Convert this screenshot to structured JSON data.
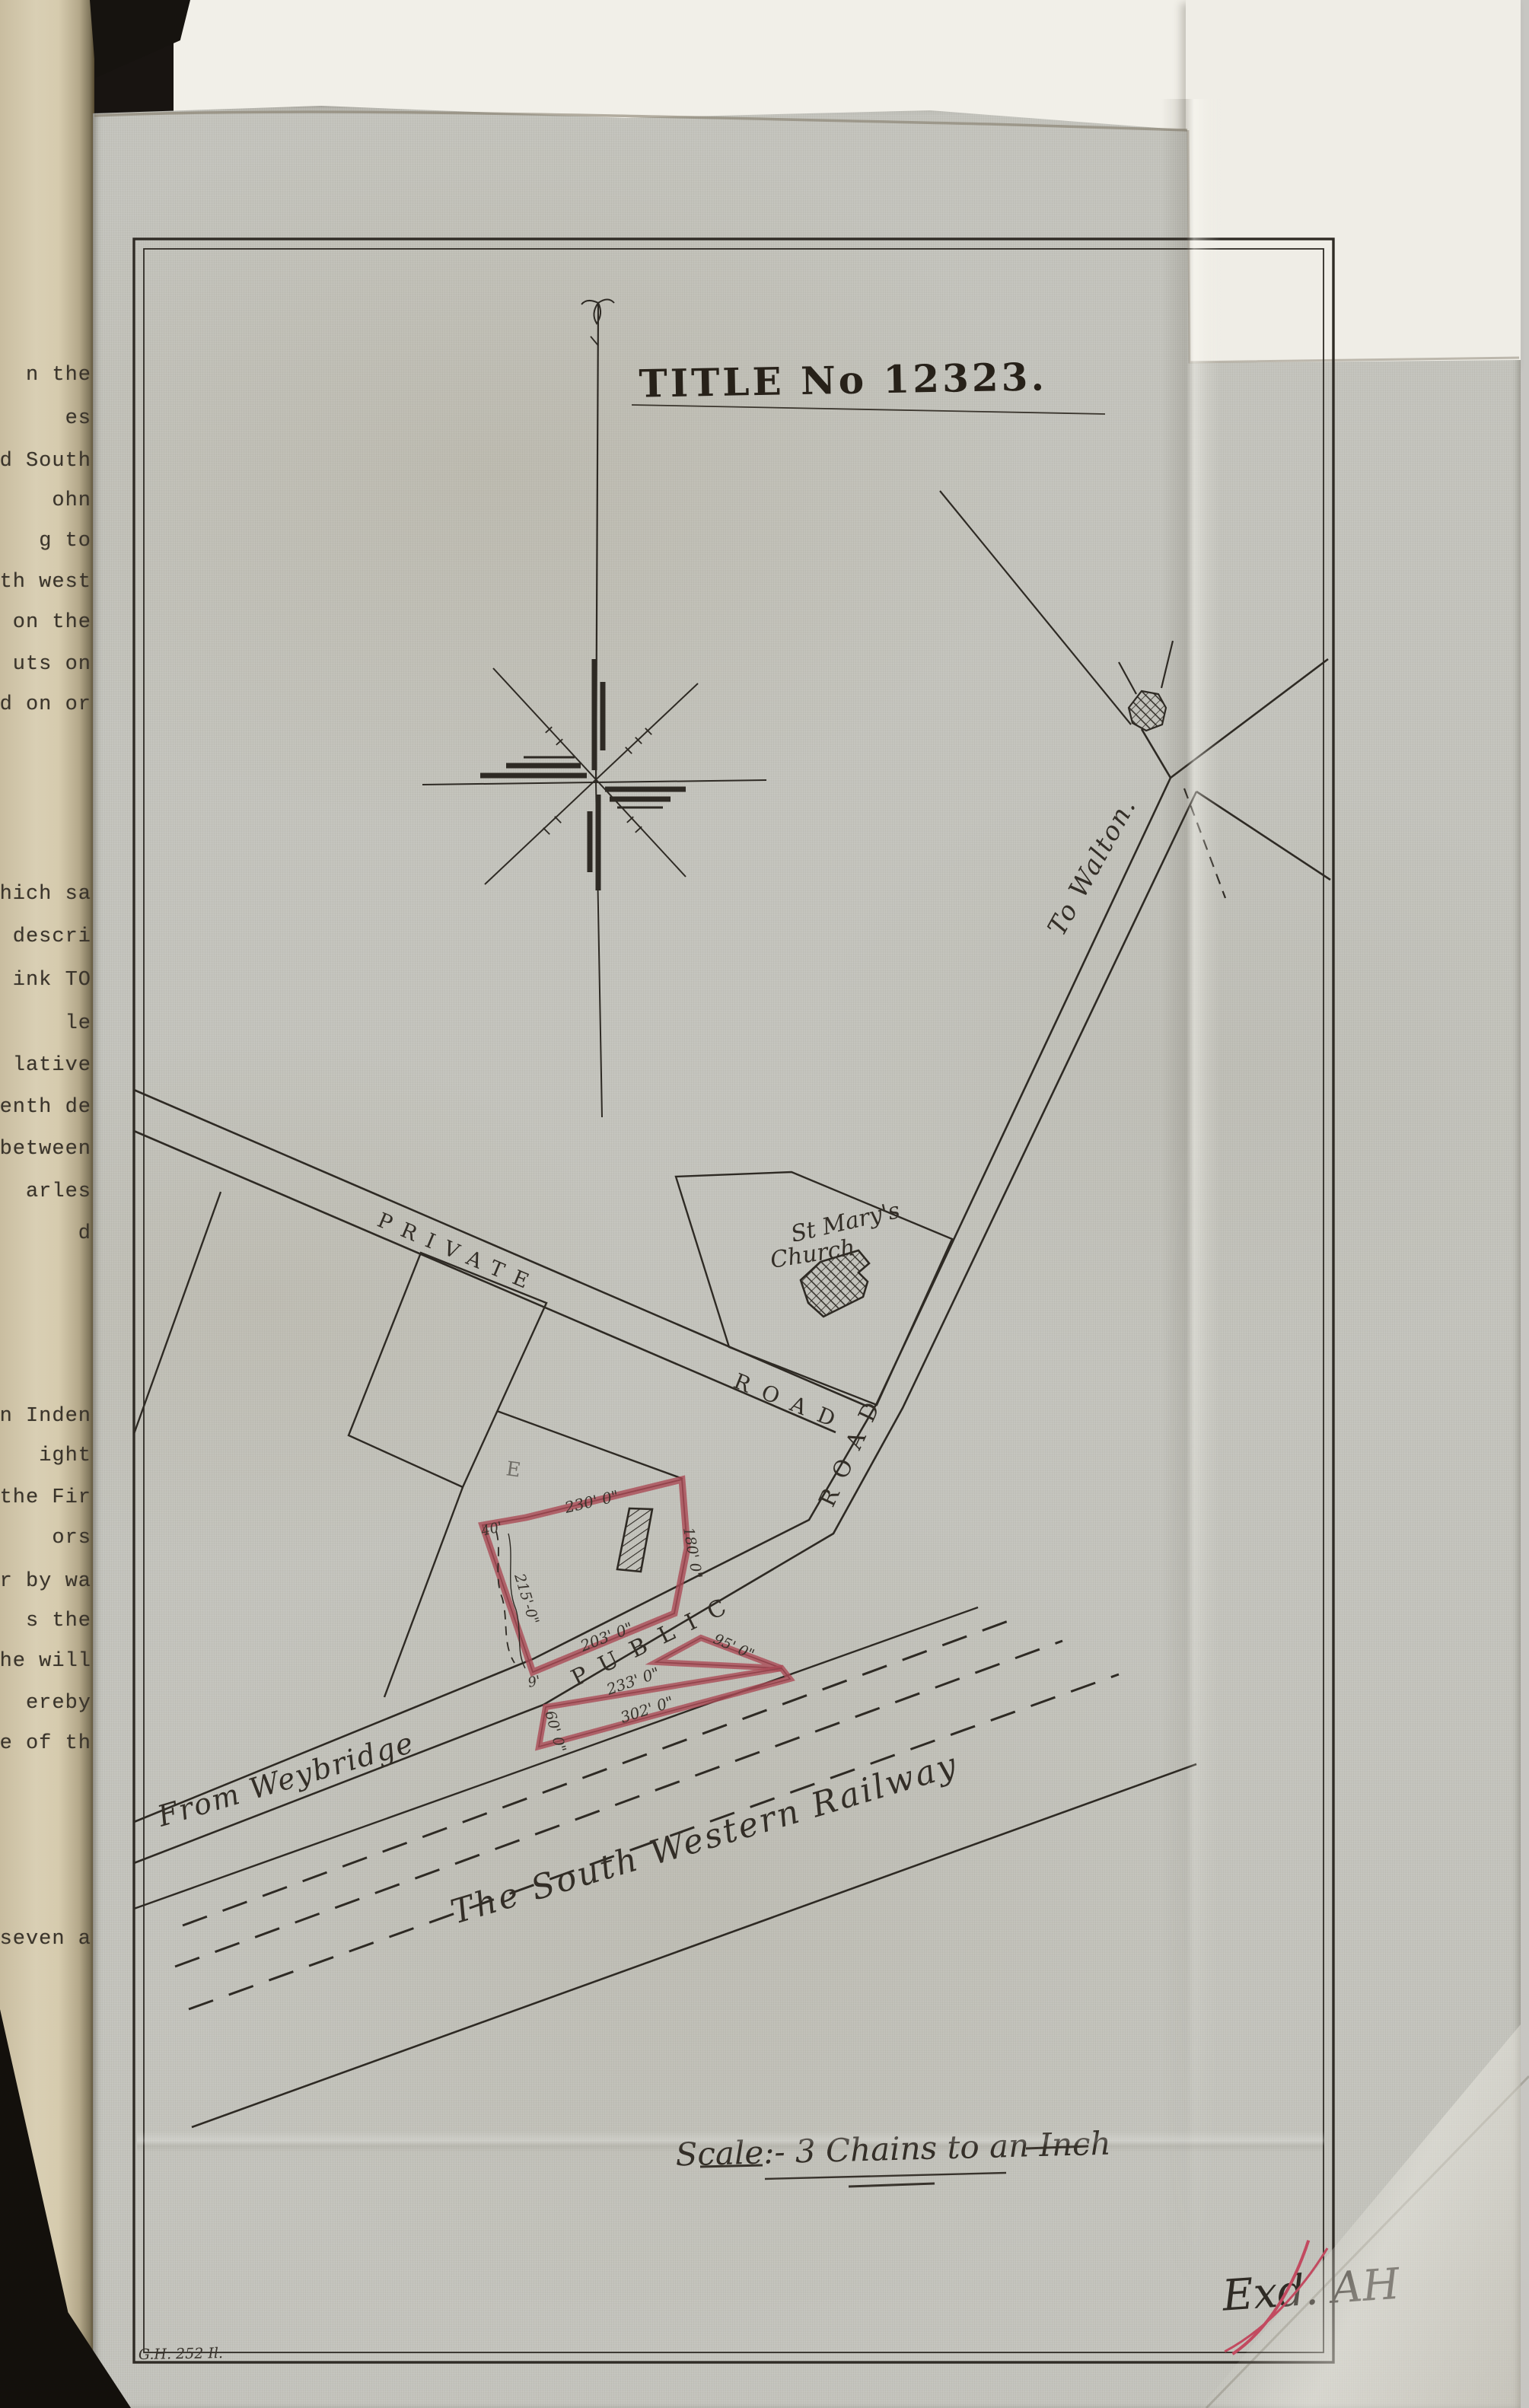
{
  "document": {
    "title": "TITLE No 12323.",
    "scale_note": "Scale:- 3 Chains to an Inch",
    "examiner_initials": "Exd. AH",
    "plate_ref": "G.H. 252 Il."
  },
  "map": {
    "labels": {
      "church_line1": "St Mary's",
      "church_line2": "Church",
      "to_walton": "To Walton.",
      "private_road": "PRIVATE",
      "private_road_2": "ROAD",
      "public_road": "PUBLIC",
      "public_road_2": "ROAD",
      "from_weybridge": "From Weybridge",
      "railway": "The South Western Railway",
      "pencil_mark": "E"
    },
    "measurements": {
      "main_top": "230' 0\"",
      "main_corner": "40'",
      "main_left": "215'-0\"",
      "main_right": "180' 0\"",
      "main_bottom": "203' 0\"",
      "corner_nine": "9'",
      "strip_top": "233' 0\"",
      "strip_bottom": "302' 0\"",
      "triangle_edge": "95' 0\"",
      "strip_left": "60' 0\""
    },
    "colors": {
      "parcel_outline": "#aa4a55",
      "signature_ink": "#c24a60",
      "drawing_ink": "#2f2b25",
      "fabric": "#c3c3bc"
    }
  },
  "left_page": {
    "fragments": [
      "n the",
      "es",
      "d South",
      "ohn",
      "g to",
      "th west",
      "on the",
      "uts on",
      "d on or",
      "hich sa",
      "descri",
      "ink TO",
      "le",
      "lative",
      "enth de",
      "between",
      "arles",
      "d",
      "n Inden",
      "ight",
      "the Fir",
      "ors",
      "r by wa",
      "s the",
      "he will",
      "ereby",
      "re of th",
      "seven a"
    ]
  }
}
